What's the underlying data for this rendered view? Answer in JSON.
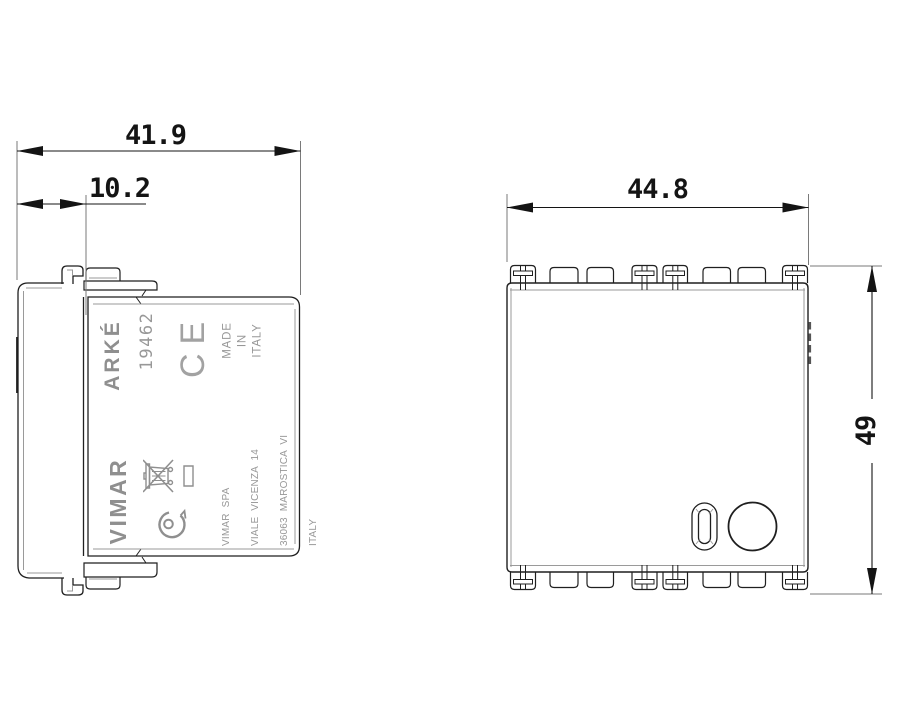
{
  "dimensions": {
    "total_depth": "41.9",
    "back_depth": "10.2",
    "front_width": "44.8",
    "front_height": "49"
  },
  "side_label": {
    "brand": "ARKÉ",
    "model": "19462",
    "ce_mark": "CE",
    "made_in": [
      "MADE",
      "IN",
      "ITALY"
    ],
    "maker": "VIMAR",
    "address": [
      "VIMAR  SPA",
      "VIALE  VICENZA  14",
      "36063  MAROSTICA  VI",
      "ITALY"
    ]
  },
  "icons": {
    "weee": "crossed-out-wheeled-bin",
    "imq": "imq-certification-mark"
  },
  "colors": {
    "line": "#1f1f1f",
    "secondary_line": "#9a9a9a",
    "label_text": "#8f8f8f",
    "background": "#ffffff"
  }
}
